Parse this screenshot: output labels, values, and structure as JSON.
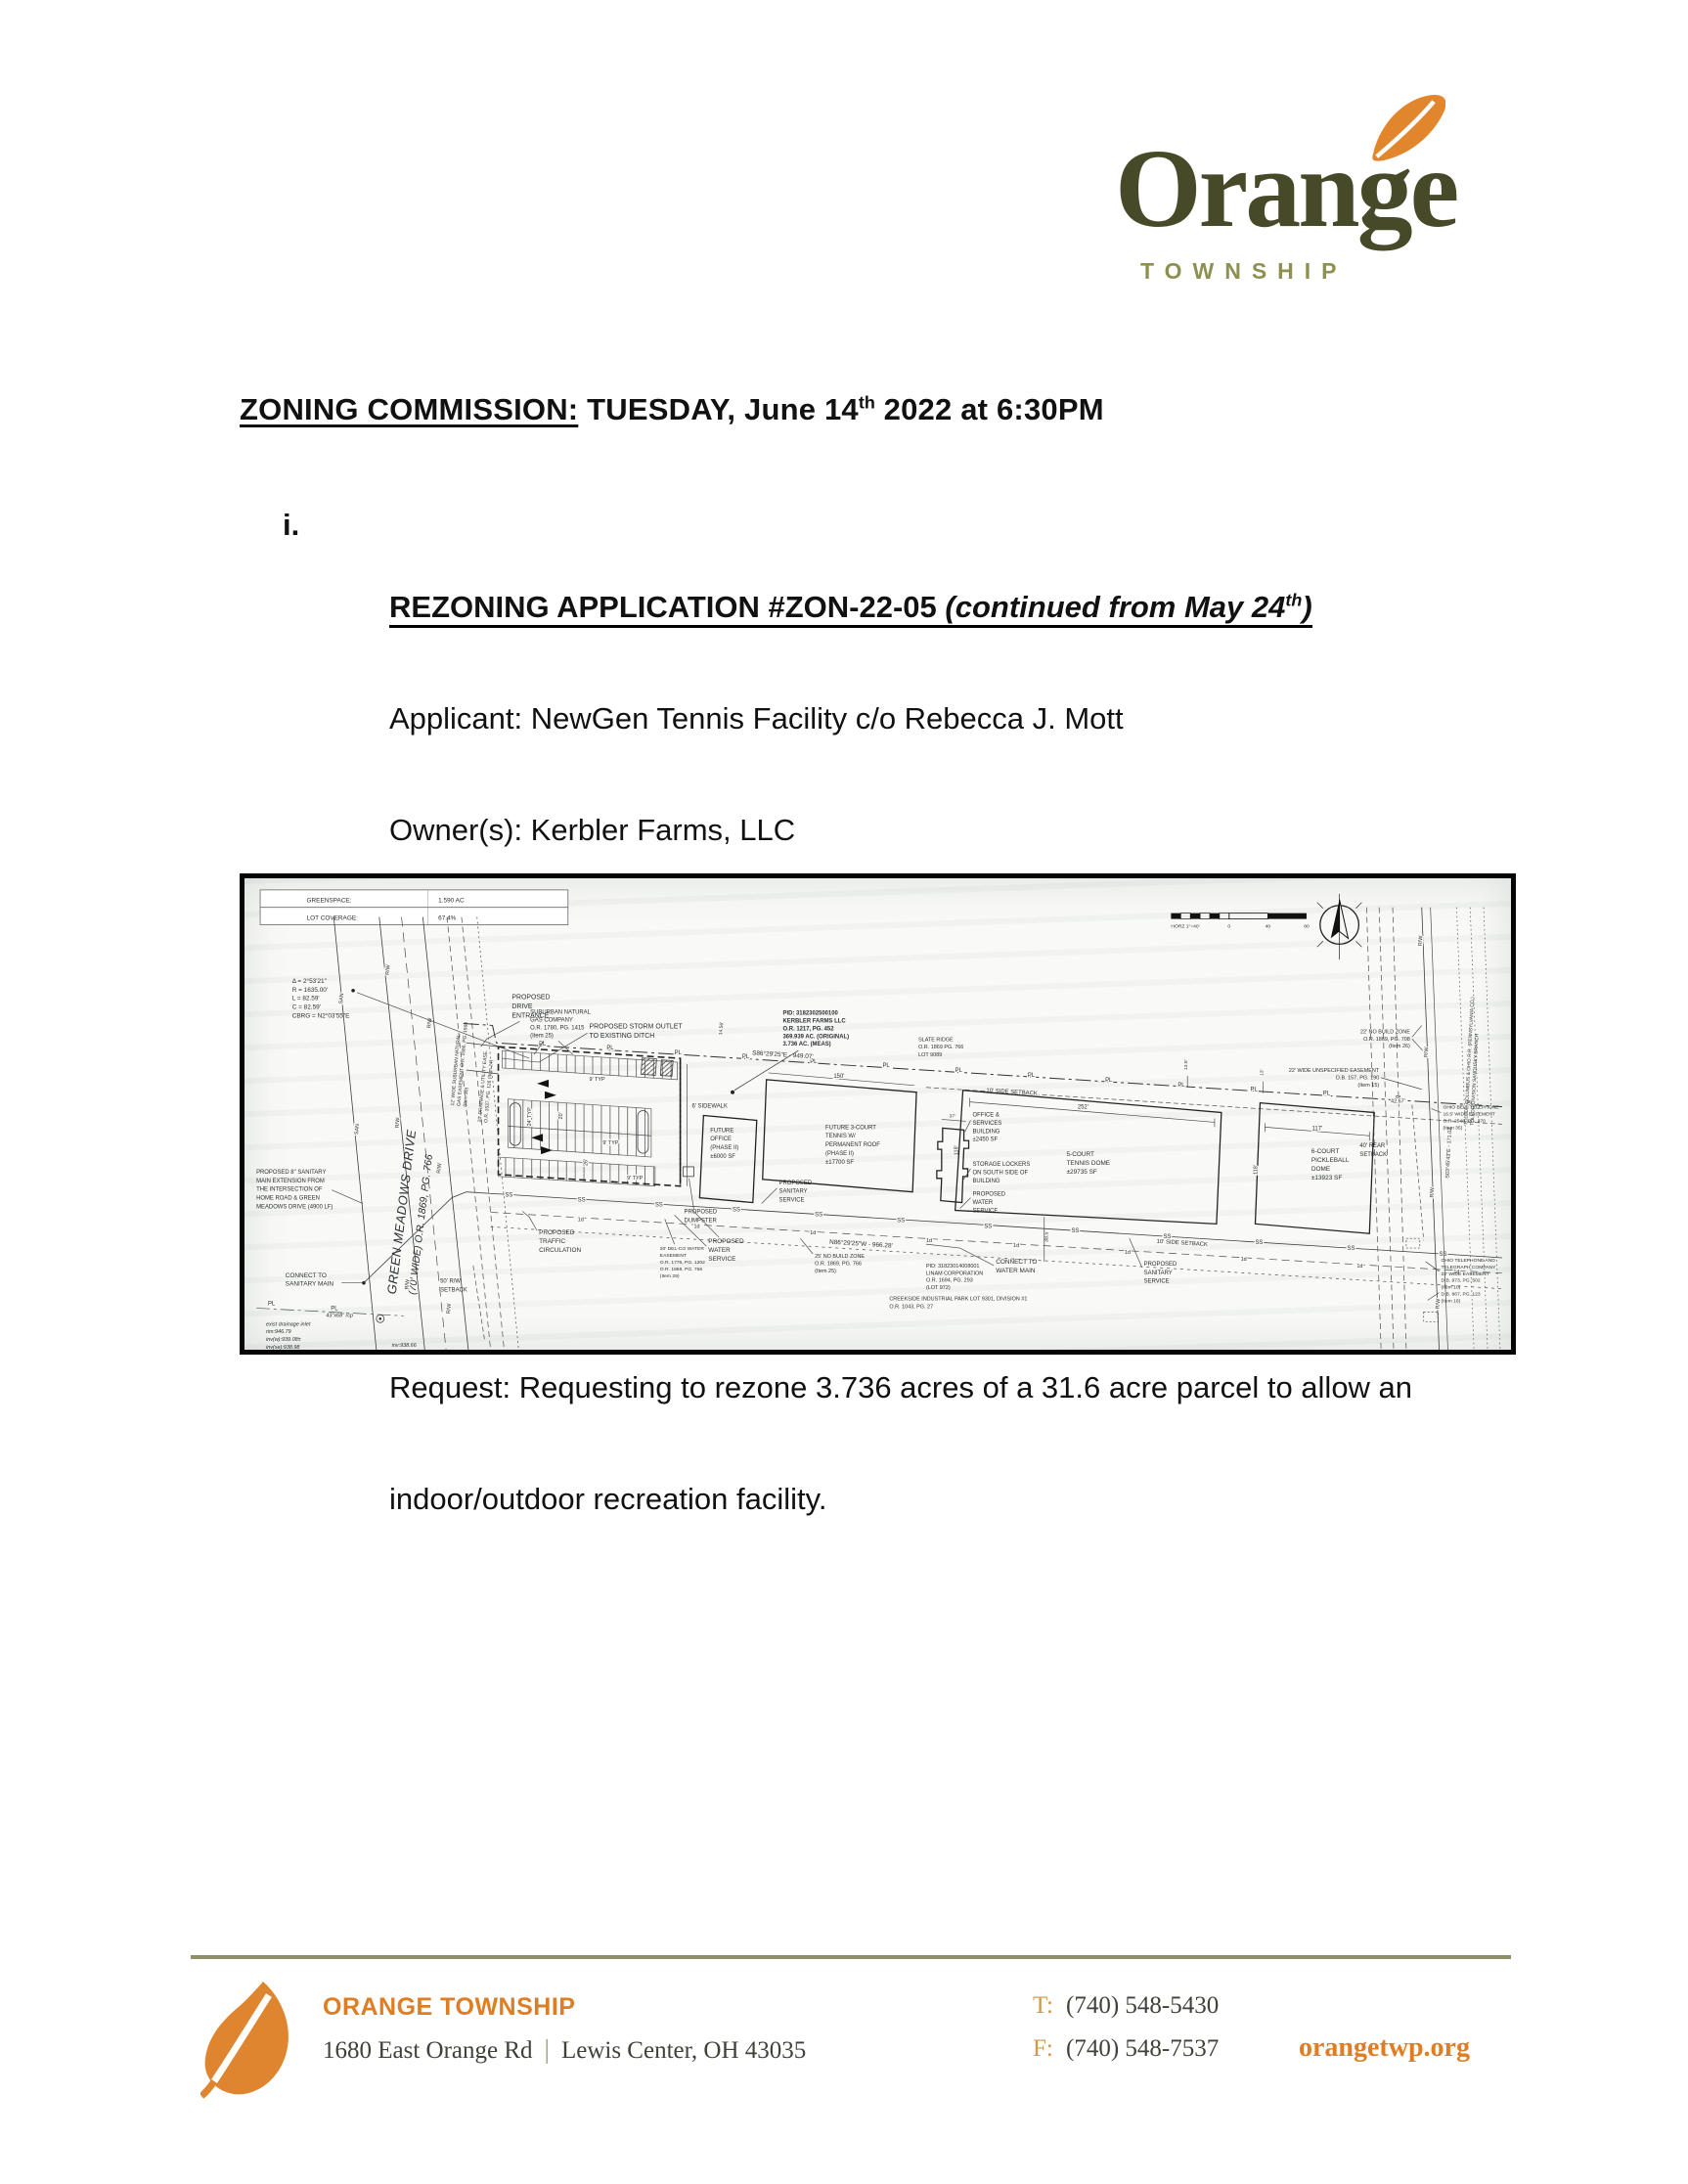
{
  "logo": {
    "word": "Orange",
    "township": "TOWNSHIP"
  },
  "heading": {
    "label": "ZONING COMMISSION:",
    "rest": " TUESDAY, June 14",
    "sup": "th",
    "tail": " 2022 at 6:30PM"
  },
  "item": {
    "marker": "i.",
    "title": {
      "main": "REZONING APPLICATION #ZON-22-05 ",
      "cont": "(continued from May 24",
      "sup": "th",
      "close": ")"
    },
    "lines": [
      "Applicant: NewGen Tennis Facility c/o Rebecca J. Mott",
      "Owner(s): Kerbler Farms, LLC",
      "Site: Green Meadows Drive, Lewis Center, OH 43035(PID# 318-230-25-",
      "001-000)",
      "Acreage: 31.6 +/- acres",
      "Zoning: Planned Commercial and Office District (PC)",
      "Request: Requesting to rezone 3.736 acres of a 31.6 acre parcel to allow an",
      "indoor/outdoor recreation facility."
    ]
  },
  "siteplan": {
    "stats": {
      "greenspace_label": "GREENSPACE:",
      "greenspace_value": "1.590 AC",
      "coverage_label": "LOT COVERAGE:",
      "coverage_value": "67.4%"
    },
    "markers": {
      "pl": "PL",
      "ss": "SS",
      "rw": "R/W",
      "san": "SAN",
      "oned": "1d"
    },
    "scale": {
      "label": "HORZ 1\"=40'",
      "t0": "0",
      "t40": "40",
      "t80": "80"
    },
    "dims": {
      "d252": "252'",
      "d150": "150'",
      "d117": "117'",
      "d118": "118'",
      "d37": "37'",
      "d42": "42.67'",
      "d24": "24' TYP",
      "d20": "20'",
      "d26": "26'",
      "d9": "9' TYP",
      "d38": "38.5'",
      "d14": "14.56'",
      "d135": "13.5'",
      "d13": "13'"
    },
    "labels": {
      "curve": "Δ = 2°53'21\"\nR = 1635.00'\nL = 82.59'\nC = 82.59'\nCBRG = N2°03'55\"E",
      "road_name": "GREEN MEADOWS DRIVE",
      "road_info": "(70' WIDE) O.R. 1869, PG. 766",
      "sanitary_main": "PROPOSED 8\" SANITARY\nMAIN EXTENSION FROM\nTHE INTERSECTION OF\nHOME ROAD & GREEN\nMEADOWS DRIVE (4900 LF)",
      "connect_sanitary": "CONNECT TO\nSANITARY MAIN",
      "drainage": "exist drainage inlet\nrim:946.79\ninv(w):939.08±\ninv(se):938.98",
      "inv2": "inv:938.66",
      "rcp": "43\"x68\" rcp",
      "rw_setback": "50' R/W\nSETBACK",
      "drive_entrance": "PROPOSED\nDRIVE\nENTRANCE",
      "storm_outlet": "PROPOSED STORM OUTLET\nTO EXISTING DITCH",
      "suburban_gas": "SUBURBAN NATURAL\nGAS COMPANY\nO.R. 1780, PG. 1415\n(Item 25)",
      "gas_easement": "12' WIDE SUBURBAN NATURAL\nGAS EASEMENT O.R. 1586, PG. 1560\n(Item 30)",
      "drainage_easement": "20' DRAINAGE & UTILITY EASE.\nO.R. 1537, PG. 126 (Item 24)",
      "pid_kerbler": "PID: 3182302500100\nKERBLER FARMS LLC\nO.R. 1217, PG. 452\n369.939 AC. (ORIGINAL)\n3.736 AC. (MEAS)",
      "sidewalk": "6' SIDEWALK",
      "future_office": "FUTURE\nOFFICE\n(PHASE II)\n±6000 SF",
      "future_tennis": "FUTURE 3-COURT\nTENNIS W/\nPERMANENT ROOF\n(PHASE II)\n±17700 SF",
      "dumpster": "PROPOSED\nDUMPSTER",
      "sanitary_service": "PROPOSED\nSANITARY\nSERVICE",
      "water_service": "PROPOSED\nWATER\nSERVICE",
      "traffic": "PROPOSED\nTRAFFIC\nCIRCULATION",
      "delco": "20' DEL-CO WATER\nEASEMENT\nO.R. 1776, PG. 1202\nO.R. 1869, PG. 766\n(Item 29)",
      "no_build_25": "25' NO BUILD ZONE\nO.R. 1869, PG. 766\n(Item 25)",
      "bearing_top": "S86°29'25\"E - 949.07'",
      "bearing_bottom": "N86°29'25\"W - 966.28'",
      "bearing_right": "S03°45'43\"E - 171.02'",
      "connect_water": "CONNECT TO\nWATER MAIN",
      "linam": "PID: 31823014008001\nLINAM CORPORATION\nO.R. 1694, PG. 293\n(LOT 972)",
      "creekside": "CREEKSIDE INDUSTRIAL PARK LOT 9301, DIVISION #1\nO.R. 1043, PG. 27",
      "office_services": "OFFICE &\nSERVICES\nBUILDING\n±2450 SF",
      "storage_lockers": "STORAGE LOCKERS\nON SOUTH SIDE OF\nBUILDING",
      "tennis_dome": "5-COURT\nTENNIS DOME\n±29735 SF",
      "pickleball": "6-COURT\nPICKLEBALL\nDOME\n±13923 SF",
      "slate_ridge": "SLATE RIDGE\nO.R. 1869 PG. 766\nLOT 9089",
      "side_setback": "10' SIDE SETBACK",
      "rear_setback": "40' REAR\nSETBACK",
      "no_build_22": "22' NO BUILD ZONE\nO.R. 1869, PG. 708\n(Item 26)",
      "unspec_easement": "22' WIDE UNSPECIFIED EASEMENT\nD.B. 157, PG. 190\n(Item 15)",
      "ohio_bell": "OHIO BELL TELEPHONE\n16.5' WIDE EASEMENT\nO.R. 2548, PG. 370\n(Item 35)",
      "ohio_tel": "OHIO TELEPHONE AND\nTELEGRAPH COMPANY\n22' WIDE EASEMENT\nD.B. 973, PG. 502\n(Item 10)\nD.B. 867, PG. 123\n(Item 16)",
      "railroad": "TOLEDO COLUMBUS & OHIO R.R. (PENNSYLVANIA CO.)\nTOLEDO DIVISION SANDUSKY BRANCH"
    }
  },
  "footer": {
    "org": "ORANGE TOWNSHIP",
    "address1": "1680 East Orange Rd",
    "address2": "Lewis Center, OH 43035",
    "t_label": "T:",
    "t_value": "(740) 548-5430",
    "f_label": "F:",
    "f_value": "(740) 548-7537",
    "website": "orangetwp.org"
  }
}
